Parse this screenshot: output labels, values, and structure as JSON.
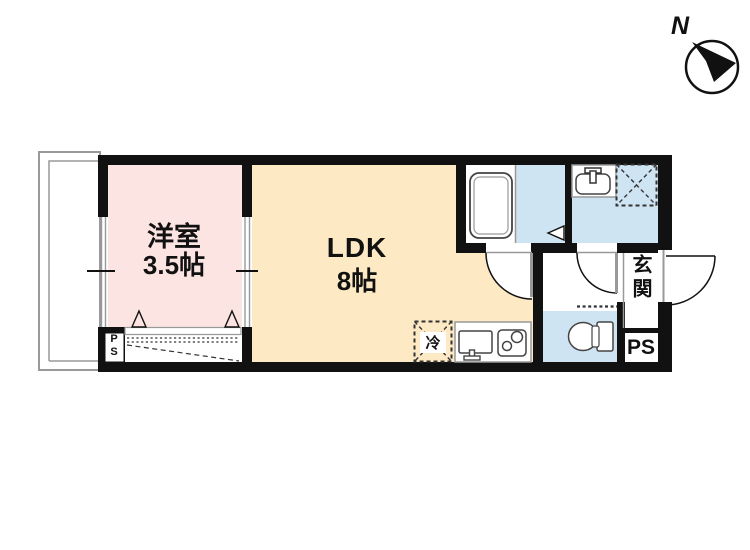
{
  "compass": {
    "north_label": "N"
  },
  "rooms": {
    "western": {
      "name": "洋室",
      "size": "3.5帖"
    },
    "ldk": {
      "name": "LDK",
      "size": "8帖"
    },
    "entrance": {
      "name": "玄関"
    },
    "pipe_space_right": {
      "label": "PS"
    },
    "pipe_space_left": {
      "line1": "P",
      "line2": "S"
    },
    "refrigerator": {
      "label": "冷"
    }
  },
  "colors": {
    "wall": "#111111",
    "pink": "#fbe4e2",
    "cream": "#fdeac4",
    "blue": "#cfe4f2",
    "gray": "#999999",
    "dark": "#333333",
    "fix": "#444444"
  }
}
